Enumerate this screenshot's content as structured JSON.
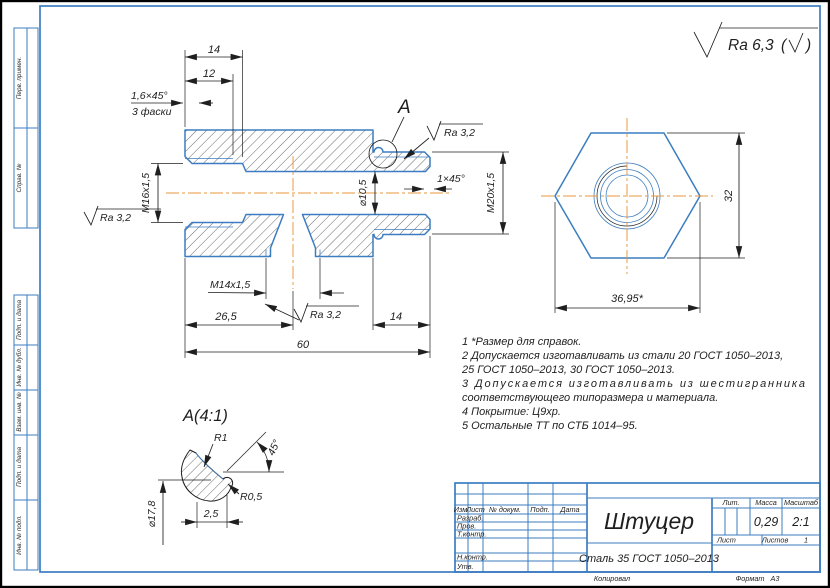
{
  "colors": {
    "line_blue": "#3c7dc1",
    "centerline_orange": "#e8973f",
    "ink": "#1f1f1f",
    "background": "#ffffff"
  },
  "sheet": {
    "general_roughness": {
      "label": "Ra 6,3",
      "paren_open": "(",
      "paren_close": ")"
    },
    "copied_label": "Копировал",
    "format_label": "Формат",
    "format_value": "А3"
  },
  "margin": {
    "labels": [
      "Перв. примен.",
      "Справ. №",
      "Подп. и дата",
      "Инв. № дубл.",
      "Взам. инв. №",
      "Подп. и дата",
      "Инв. № подл."
    ]
  },
  "main_view": {
    "detail_marker": "A",
    "roughness_local": "Ra 3,2",
    "dims": {
      "hole_depth": "14",
      "thread_depth": "12",
      "chamfer": "1,6×45°",
      "chamfer_note": "3 фаски",
      "thread_left": "M16x1,5",
      "bore_dia": "⌀10,5",
      "chamfer_right": "1×45°",
      "thread_right": "M20x1,5",
      "thread_bottom": "M14x1,5",
      "hole_position": "26,5",
      "thread_right_len": "14",
      "total_len": "60"
    }
  },
  "hex_view": {
    "dims": {
      "across_flats": "32",
      "across_corners": "36,95*"
    }
  },
  "detail_view": {
    "title": "A(4:1)",
    "dims": {
      "radius_1": "R1",
      "radius_05": "R0,5",
      "angle": "45°",
      "groove_width": "2,5",
      "dia": "⌀17,8"
    }
  },
  "notes": {
    "lines": [
      "1 *Размер для справок.",
      "2 Допускается изготавливать из стали 20 ГОСТ 1050–2013,",
      "25 ГОСТ 1050–2013, 30 ГОСТ 1050–2013.",
      "3 Допускается изготавливать из шестигранника",
      "соответствующего типоразмера и материала.",
      "4 Покрытие: Ц9хр.",
      "5 Остальные ТТ по СТБ 1014–95."
    ]
  },
  "title_block": {
    "header_cols": {
      "izm": "Изм.",
      "list": "Лист",
      "doc": "№ докум.",
      "podp": "Подп.",
      "data": "Дата"
    },
    "rows": {
      "razrab": "Разраб.",
      "prov": "Пров.",
      "tkontr": "Т.контр.",
      "nkontr": "Н.контр.",
      "utv": "Утв."
    },
    "part_name": "Штуцер",
    "material": "Сталь 35 ГОСТ 1050–2013",
    "lit_label": "Лит.",
    "mass_label": "Масса",
    "scale_label": "Масштаб",
    "mass_value": "0,29",
    "scale_value": "2:1",
    "sheet_label": "Лист",
    "sheets_label": "Листов",
    "sheets_value": "1"
  }
}
